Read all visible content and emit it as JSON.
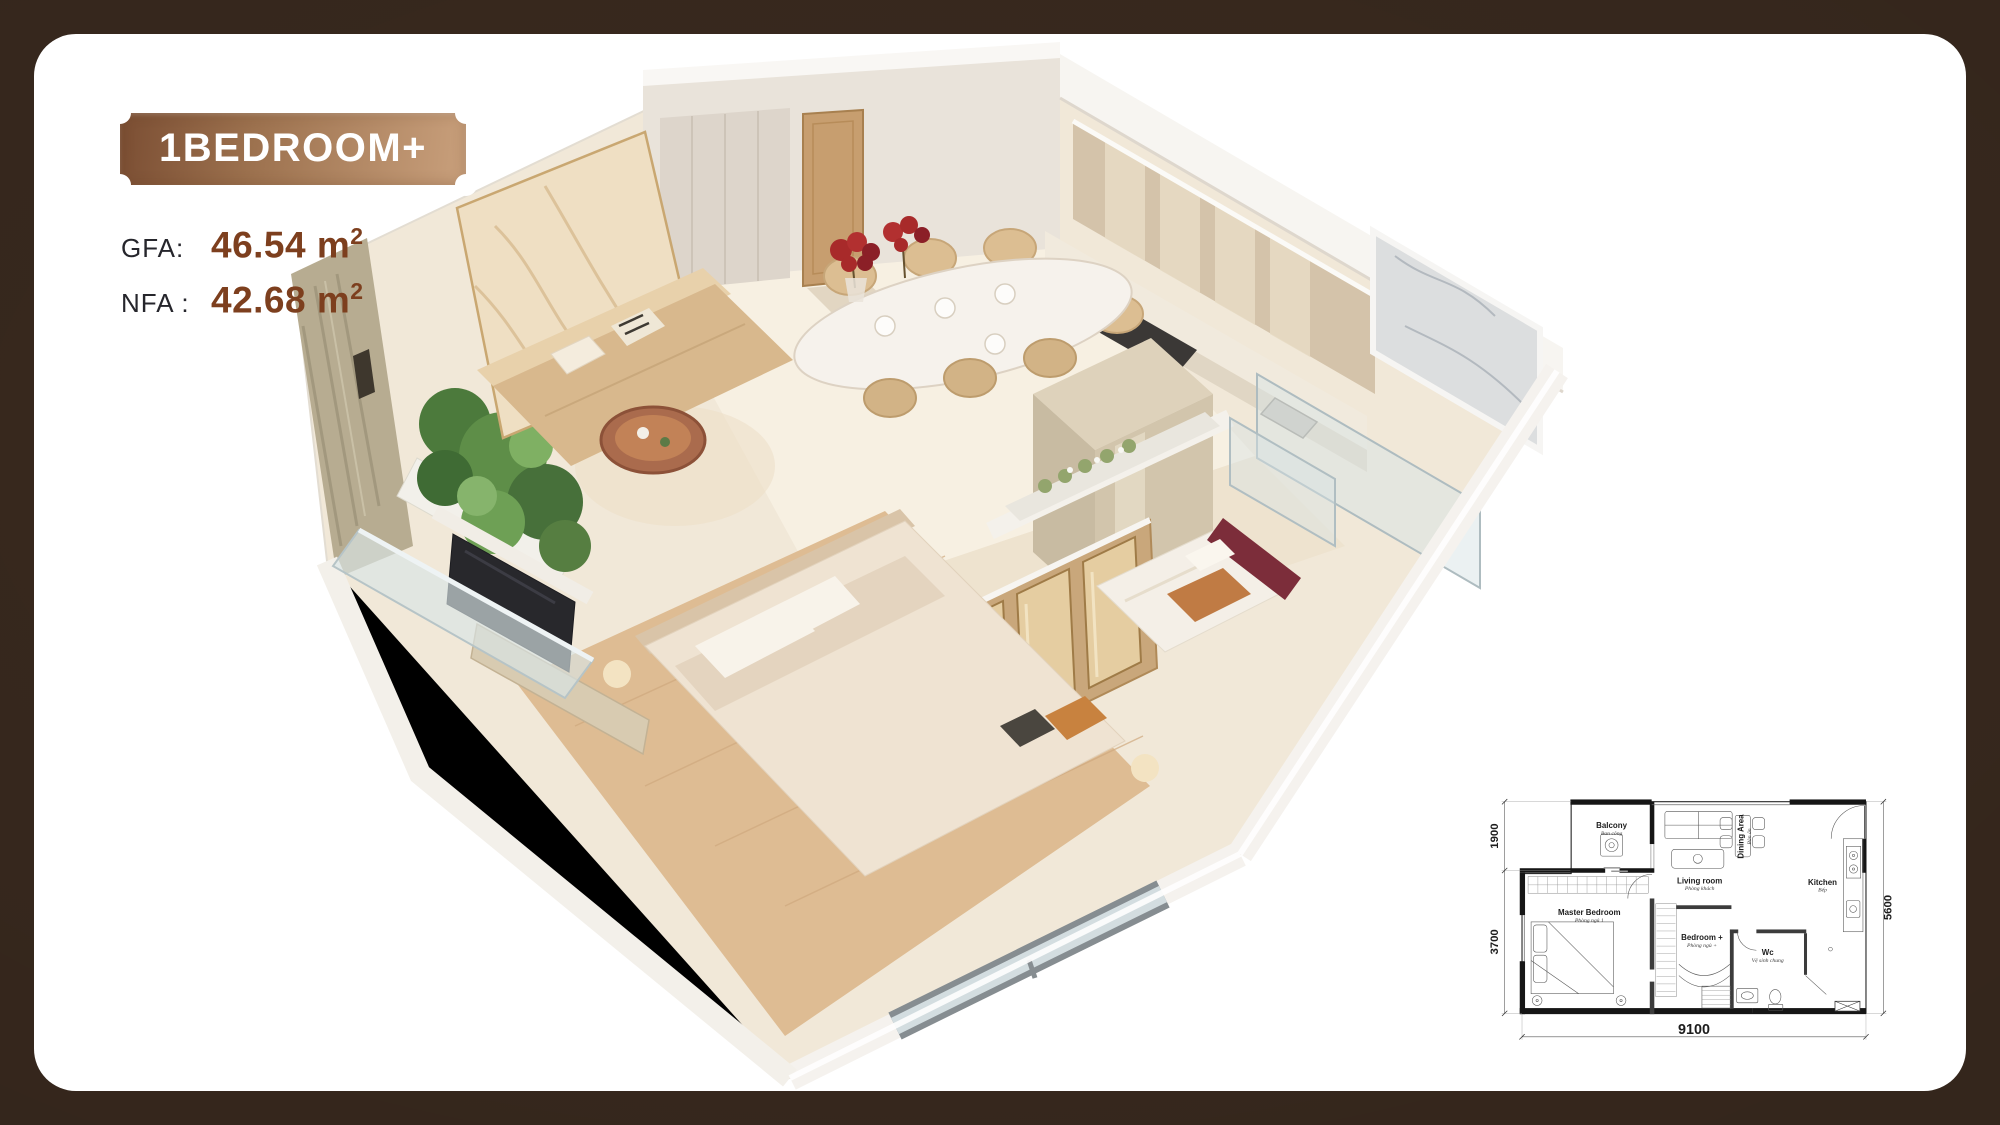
{
  "colors": {
    "background": "#3a2a1f",
    "card": "#ffffff",
    "badge_dark": "#7b4e33",
    "badge_light": "#c9a07c",
    "value_brown": "#7d3f1e",
    "label_dark": "#26262c"
  },
  "header": {
    "badge_label": "1BEDROOM+"
  },
  "stats": [
    {
      "label": "GFA:",
      "value": "46.54 m",
      "sup": "2"
    },
    {
      "label": "NFA :",
      "value": "42.68 m",
      "sup": "2"
    }
  ],
  "floorplan": {
    "rooms": [
      {
        "name": "Balcony",
        "vi": "Ban công"
      },
      {
        "name": "Living room",
        "vi": "Phòng khách"
      },
      {
        "name": "Dining Area",
        "vi": "Bàn ăn"
      },
      {
        "name": "Kitchen",
        "vi": "Bếp"
      },
      {
        "name": "Master Bedroom",
        "vi": "Phòng ngủ 1"
      },
      {
        "name": "Bedroom +",
        "vi": "Phòng ngủ +"
      },
      {
        "name": "Wc",
        "vi": "Vệ sinh chung"
      }
    ],
    "dimensions": {
      "balcony_depth": "1900",
      "master_depth": "3700",
      "total_depth": "5600",
      "total_width": "9100"
    }
  }
}
